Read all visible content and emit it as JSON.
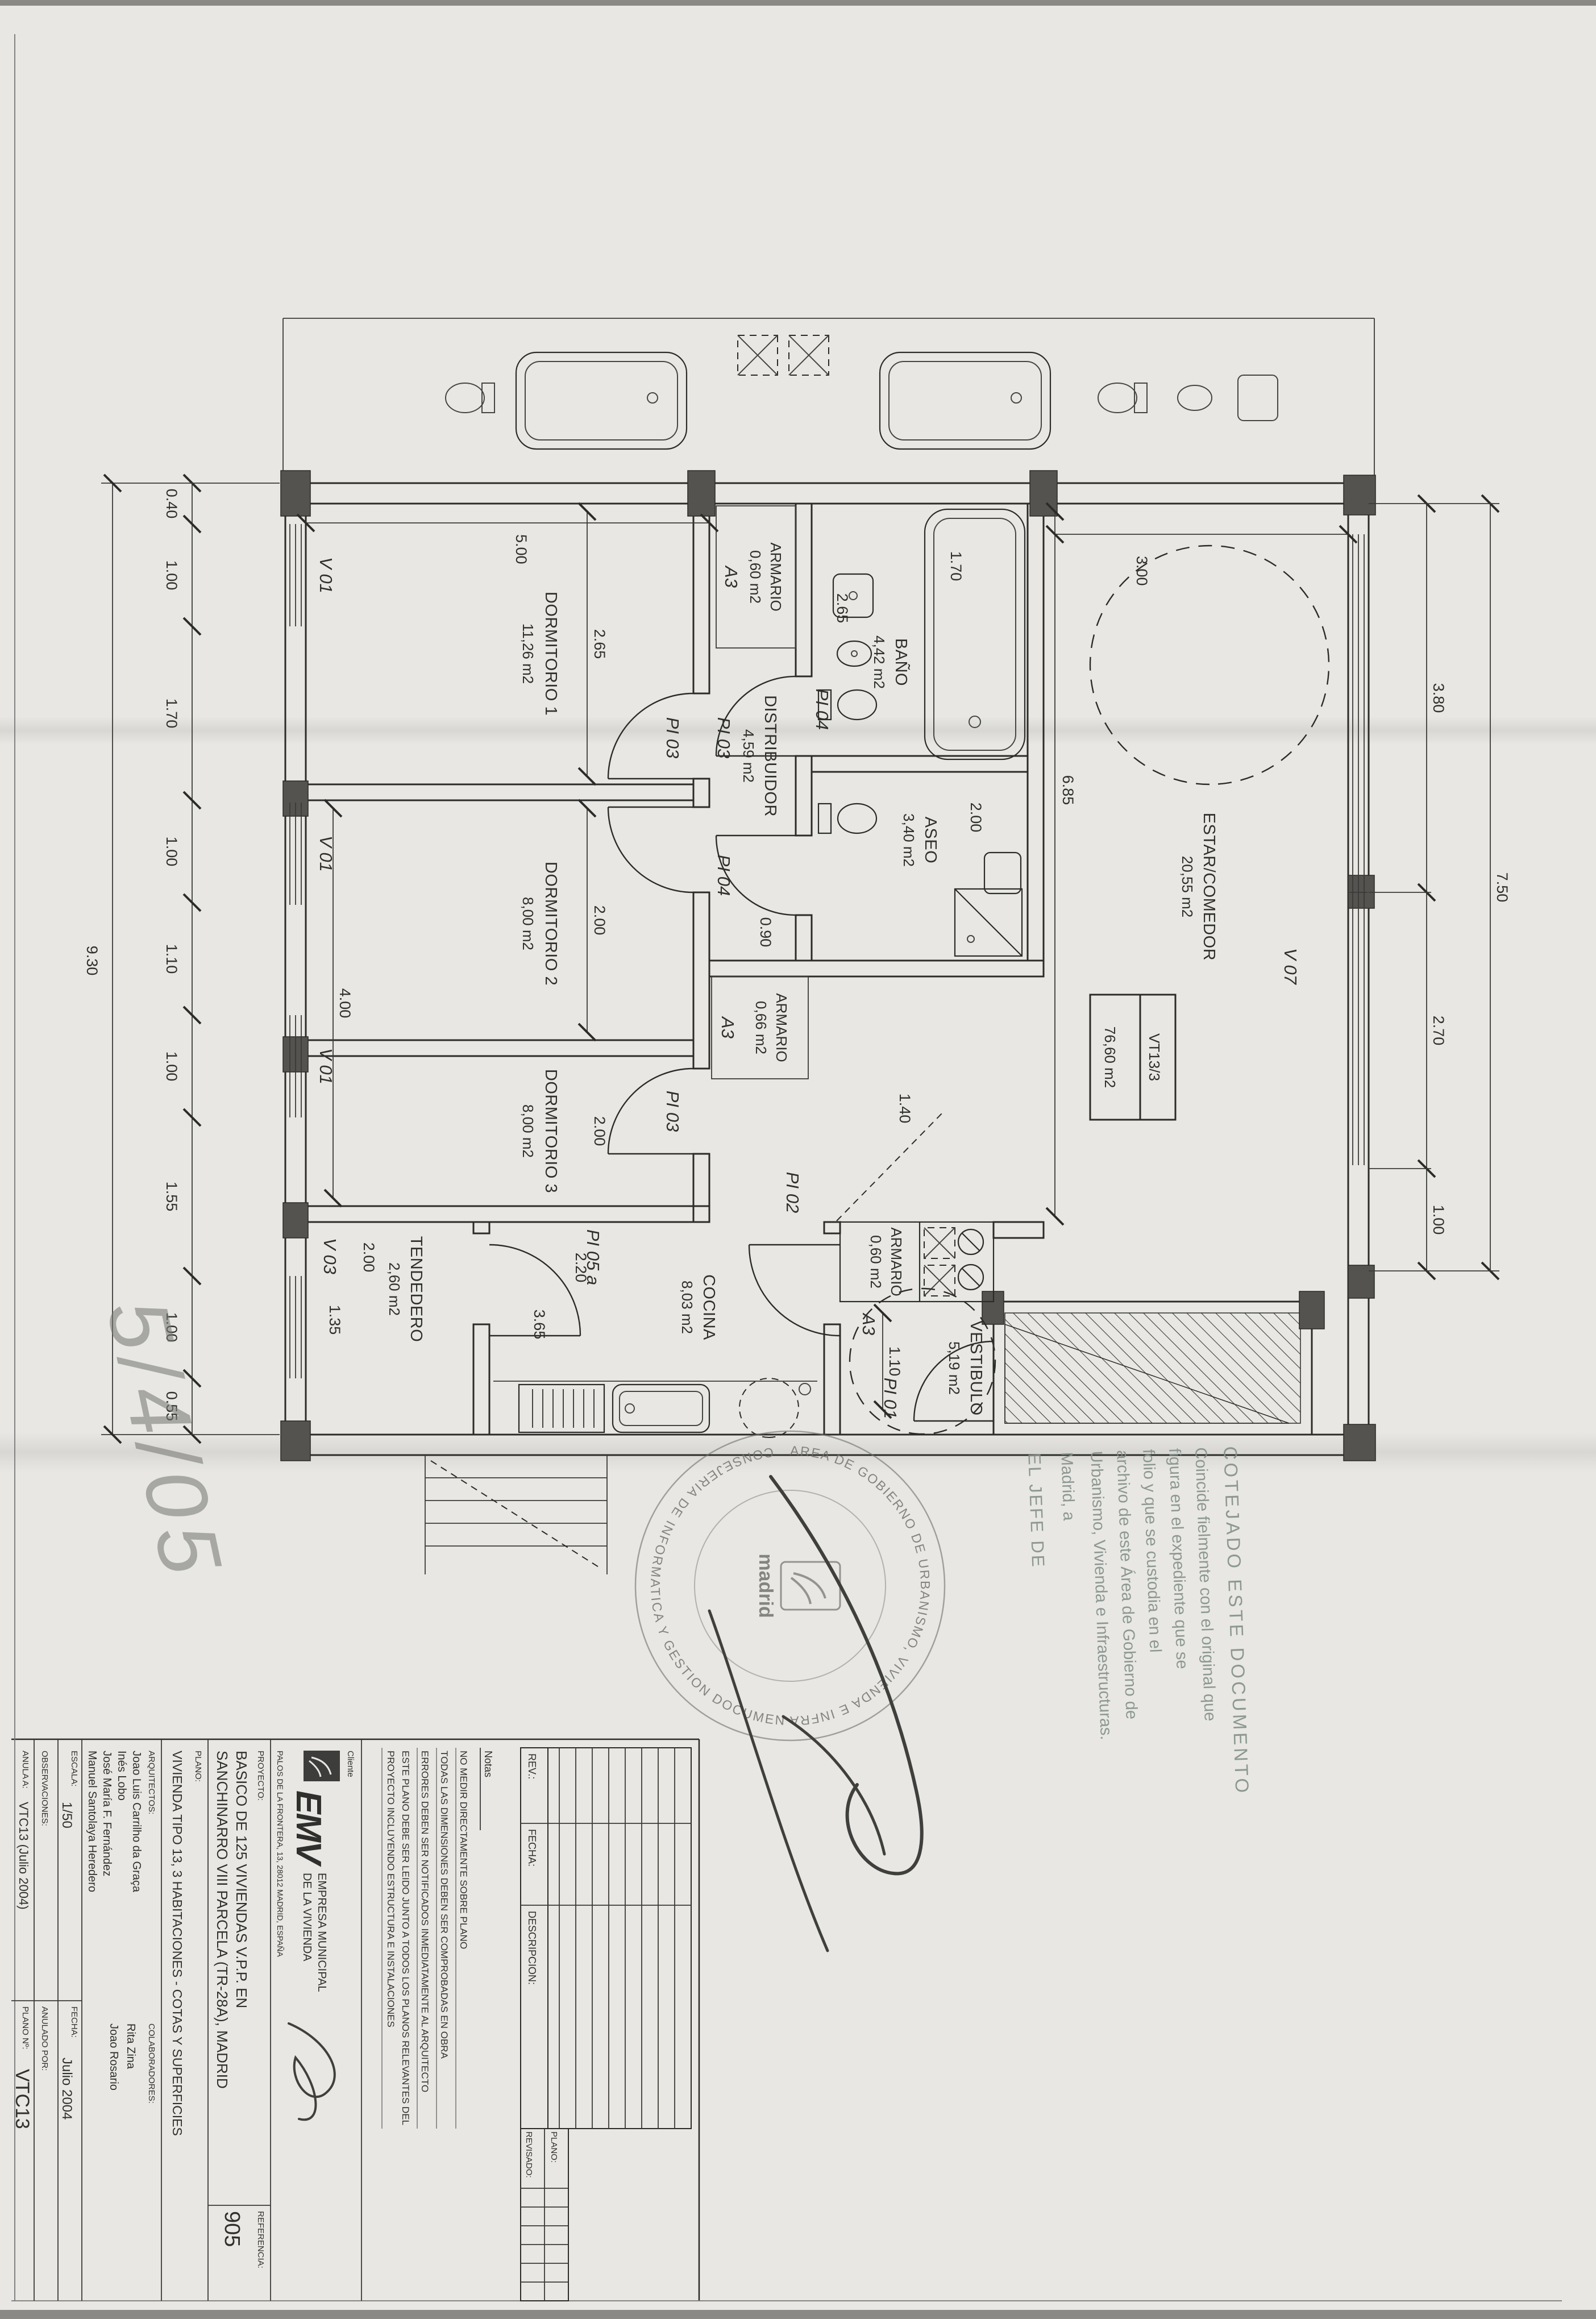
{
  "plan": {
    "unit_box": {
      "code": "VT13/3",
      "area": "76,60 m2"
    },
    "rooms": [
      {
        "name": "DORMITORIO 1",
        "area": "11,26 m2"
      },
      {
        "name": "DORMITORIO 2",
        "area": "8,00 m2"
      },
      {
        "name": "DORMITORIO 3",
        "area": "8,00 m2"
      },
      {
        "name": "BAÑO",
        "area": "4,42 m2"
      },
      {
        "name": "ASEO",
        "area": "3,40 m2"
      },
      {
        "name": "DISTRIBUIDOR",
        "area": "4,59 m2"
      },
      {
        "name": "ESTAR/COMEDOR",
        "area": "20,55 m2"
      },
      {
        "name": "COCINA",
        "area": "8,03 m2"
      },
      {
        "name": "TENDEDERO",
        "area": "2,60 m2"
      },
      {
        "name": "VESTIBULO",
        "area": "5,19 m2"
      },
      {
        "name": "ARMARIO",
        "area": "0,60 m2"
      },
      {
        "name": "ARMARIO",
        "area": "0,66 m2"
      },
      {
        "name": "ARMARIO",
        "area": "0,60 m2"
      }
    ],
    "windows": [
      "V 01",
      "V 01",
      "V 01",
      "V 03",
      "V 07"
    ],
    "doors": [
      "PI 01",
      "PI 02",
      "PI 03",
      "PI 03",
      "PI 04",
      "PI 04",
      "PI 05 a"
    ],
    "wardrobe_code": "A3",
    "dims": {
      "bottom": [
        "0.40",
        "1.00",
        "1.70",
        "1.00",
        "1.10",
        "1.00",
        "1.55",
        "1.00",
        "0.55"
      ],
      "bottom_total": "9.30",
      "top": [
        "3.80",
        "2.70",
        "1.00"
      ],
      "top_total": "7.50",
      "interior": [
        "5.00",
        "2.65",
        "2.00",
        "2.00",
        "4.00",
        "1.70",
        "2.65",
        "2.00",
        "0.90",
        "1.40",
        "6.85",
        "3.00",
        "2.20",
        "3.65",
        "2.00",
        "1.35",
        "1.10"
      ]
    }
  },
  "handwriting": {
    "date": "5/4/05"
  },
  "stamps": {
    "round_ring_top": "AREA DE GOBIERNO DE URBANISMO, VIVIENDA E INFRAESTRUCTURAS",
    "round_ring_bottom": "CONSEJERIA DE INFORMATICA Y GESTION DOCUMENTAL",
    "round_center": "madrid",
    "cotejo": [
      "COTEJADO ESTE DOCUMENTO",
      "Coincide fielmente con el original que",
      "figura en el expediente            que se",
      "folio            y que se custodia en el",
      "archivo de este Área de Gobierno de",
      "Urbanismo, Vivienda e Infraestructuras.",
      "Madrid, a",
      "EL JEFE DE"
    ]
  },
  "title_block": {
    "rev_table": {
      "rev": "REV.:",
      "fecha": "FECHA:",
      "descripcion": "DESCRIPCION:"
    },
    "mini_table": {
      "plano": "PLANO:",
      "revisado": "REVISADO:"
    },
    "notes_label": "Notas",
    "notes": [
      "NO MEDIR DIRECTAMENTE SOBRE PLANO",
      "TODAS LAS DIMENSIONES DEBEN SER COMPROBADAS EN OBRA",
      "ERRORES DEBEN SER NOTIFICADOS INMEDIATAMENTE AL ARQUITECTO",
      "ESTE PLANO DEBE SER LEIDO JUNTO A TODOS LOS PLANOS RELEVANTES DEL",
      "PROYECTO INCLUYENDO ESTRUCTURA E INSTALACIONES"
    ],
    "client_label": "Cliente",
    "client_logo": "EMV",
    "client_name1": "EMPRESA MUNICIPAL",
    "client_name2": "DE LA VIVIENDA",
    "client_address": "PALOS DE LA FRONTERA, 13, 28012 MADRID, ESPAÑA",
    "project_label": "PROYECTO:",
    "project1": "BASICO DE 125 VIVIENDAS V.P.P. EN",
    "project2": "SANCHINARRO VIII PARCELA (TR-28A), MADRID",
    "referencia_label": "REFERENCIA:",
    "referencia": "905",
    "plano_label": "PLANO:",
    "plano_title": "VIVIENDA TIPO 13, 3 HABITACIONES - COTAS Y SUPERFICIES",
    "architects_label": "ARQUITECTOS:",
    "architects": [
      "Joao Luis Carrilho da Graça",
      "Inés Lobo",
      "José María F. Fernández",
      "Manuel Santolaya Heredero"
    ],
    "collaborators_label": "COLABORADORES:",
    "collaborators": [
      "Rita Zina",
      "Joao Rosario"
    ],
    "escala_label": "ESCALA:",
    "escala": "1/50",
    "fecha_label": "FECHA:",
    "fecha": "Julio 2004",
    "observaciones_label": "OBSERVACIONES:",
    "anulado_label": "ANULADO POR:",
    "anula_label": "ANULA A:",
    "anula": "VTC13 (Julio 2004)",
    "plano_num_label": "PLANO Nº:",
    "plano_num": "VTC13"
  }
}
